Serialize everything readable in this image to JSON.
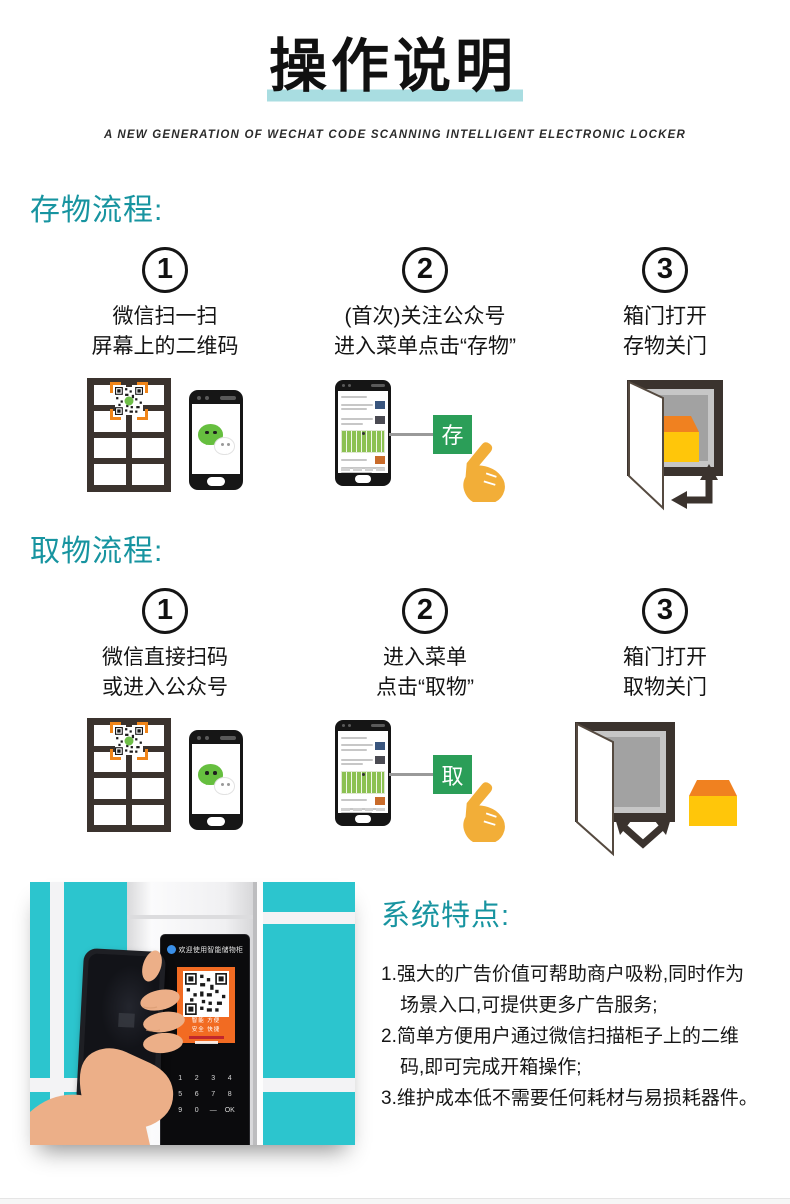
{
  "title": {
    "text": "操作说明",
    "subtitle": "A NEW GENERATION OF WECHAT CODE SCANNING INTELLIGENT ELECTRONIC LOCKER"
  },
  "sections": {
    "store": {
      "heading": "存物流程:",
      "steps": [
        {
          "number": "1",
          "line1": "微信扫一扫",
          "line2": "屏幕上的二维码"
        },
        {
          "number": "2",
          "line1": "(首次)关注公众号",
          "line2": "进入菜单点击“存物”"
        },
        {
          "number": "3",
          "line1": "箱门打开",
          "line2": "存物关门"
        }
      ],
      "button_label": "存"
    },
    "pick": {
      "heading": "取物流程:",
      "steps": [
        {
          "number": "1",
          "line1": "微信直接扫码",
          "line2": "或进入公众号"
        },
        {
          "number": "2",
          "line1": "进入菜单",
          "line2": "点击“取物”"
        },
        {
          "number": "3",
          "line1": "箱门打开",
          "line2": "取物关门"
        }
      ],
      "button_label": "取"
    }
  },
  "features": {
    "heading": "系统特点:",
    "items": [
      {
        "line1": "1.强大的广告价值可帮助商户吸粉,同时作为",
        "line2": "场景入口,可提供更多广告服务;"
      },
      {
        "line1": "2.简单方便用户通过微信扫描柜子上的二维",
        "line2": "码,即可完成开箱操作;"
      },
      {
        "line1": "3.维护成本低不需要任何耗材与易损耗器件。",
        "line2": ""
      }
    ]
  },
  "photo": {
    "panel_title": "欢迎使用智能储物柜",
    "qr_caption_1": "智能 方便",
    "qr_caption_2": "安全 快捷",
    "keypad": [
      "1",
      "2",
      "3",
      "4",
      "5",
      "6",
      "7",
      "8",
      "9",
      "0",
      "—",
      "OK"
    ]
  },
  "colors": {
    "heading_teal": "#1794a0",
    "title_underline": "#a9dde1",
    "locker_door_teal": "#2cc5ce",
    "wechat_green": "#66bf3f",
    "action_button_green": "#2b9e58",
    "hand_yellow": "#f2ae38",
    "package_yellow": "#ffc60a",
    "package_orange": "#f08120",
    "frame_dark": "#3b332e",
    "qr_card_orange": "#f26b22"
  }
}
